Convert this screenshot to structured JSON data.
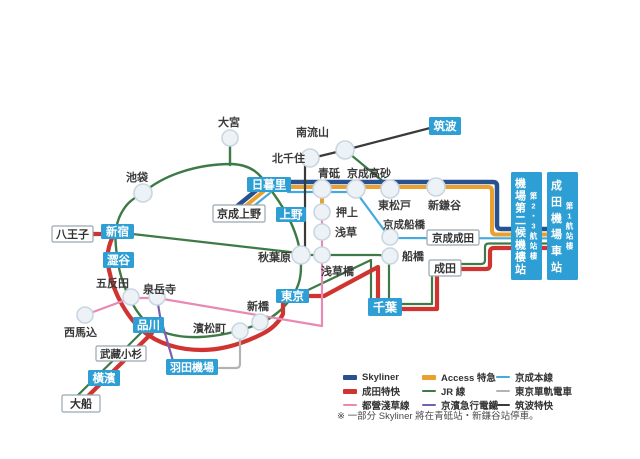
{
  "canvas": {
    "width": 640,
    "height": 459,
    "background": "#ffffff"
  },
  "colors": {
    "skyliner": "#27518f",
    "nex": "#cf3430",
    "asakusa": "#e88ab4",
    "access": "#e9a02c",
    "jr": "#3d7a46",
    "keikyu": "#7a5fae",
    "keisei": "#45aadd",
    "monorail": "#b3b3b3",
    "tsukuba": "#3a3a3a",
    "station_box": "#2e9fd4",
    "circle_fill": "#edf2f7",
    "circle_stroke": "#c9d6e2",
    "label_color": "#3b3b3b"
  },
  "map": {
    "lines": [
      {
        "name": "jr-yamanote-loop",
        "color": "jr",
        "width": 2.4,
        "d": "M143,193 C162,176 195,164 232,164 C252,165 260,174 268,186 C280,202 296,225 300,252 C303,276 299,287 291,298 C283,310 270,320 256,325 C240,331 222,336 200,337 C178,338 158,333 146,322 C132,308 121,283 118,262 C115,244 114,231 119,218 C125,204 132,199 143,193 Z"
      },
      {
        "name": "jr-omiya-spur",
        "color": "jr",
        "width": 2.4,
        "d": "M230,146 L230,165"
      },
      {
        "name": "jr-chuo-line",
        "color": "jr",
        "width": 2.2,
        "d": "M115,232 L299,253"
      },
      {
        "name": "jr-sobu-line",
        "color": "jr",
        "width": 2.2,
        "d": "M301,255 L378,255 Q389,255 389,263 L389,298"
      },
      {
        "name": "jr-sobu-rapid",
        "color": "jr",
        "width": 2.2,
        "d": "M306,291 L371,260 L371,298"
      },
      {
        "name": "jr-musashino-line",
        "color": "jr",
        "width": 2.2,
        "d": "M345,150 L390,187"
      },
      {
        "name": "jr-chiba-narita",
        "color": "jr",
        "width": 2.2,
        "d": "M402,304 L432,304 L432,277"
      },
      {
        "name": "jr-narita-airport",
        "color": "jr",
        "width": 2.2,
        "d": "M460,264 L481,264 Q485,264 485,260 L485,247 Q485,243.5 489,243.5 L575,243.5"
      },
      {
        "name": "jr-shinagawa-ofuna",
        "color": "jr",
        "width": 2.2,
        "d": "M146,328 L74,399"
      },
      {
        "name": "nex-west",
        "color": "nex",
        "width": 4.2,
        "d": "M92,234 L114,234 C108,246 106,256 109,270 C114,295 128,318 143,331 C158,344 180,350 202,350 C226,350 248,341 262,334 C272,329 279,322 283,314 L283,301"
      },
      {
        "name": "nex-tokyo-chiba",
        "color": "nex",
        "width": 4.2,
        "d": "M308,296 L324,296 L378,267 L378,298"
      },
      {
        "name": "nex-chiba-narita",
        "color": "nex",
        "width": 4.2,
        "d": "M402,309 L437,309 L437,277"
      },
      {
        "name": "nex-narita-airport",
        "color": "nex",
        "width": 4.2,
        "d": "M460,269 L486,269 Q490,269 490,265 L490,252 Q490,248 494,248 L575,248"
      },
      {
        "name": "nex-ofuna-branch",
        "color": "nex",
        "width": 4.2,
        "d": "M152,333 L80,404"
      },
      {
        "name": "skyliner-ueno-link",
        "color": "skyliner",
        "width": 4.5,
        "d": "M236,207 L258,189"
      },
      {
        "name": "skyliner-main",
        "color": "skyliner",
        "width": 4.5,
        "d": "M288,182 L493,182 Q497,182 497,186 L497,225 Q497,229 501,229 L575,229"
      },
      {
        "name": "access-ueno-link",
        "color": "access",
        "width": 4,
        "d": "M243,208 L264,191"
      },
      {
        "name": "access-main",
        "color": "access",
        "width": 4,
        "d": "M288,187 L488,187 Q492,187 492,191 L492,230.5 Q492,234.5 496,234.5 L575,234.5"
      },
      {
        "name": "access-oshiage-branch",
        "color": "access",
        "width": 4,
        "d": "M322,212 L322,189"
      },
      {
        "name": "keisei-ueno-link",
        "color": "keisei",
        "width": 2.2,
        "d": "M250,209 L270,193"
      },
      {
        "name": "keisei-main",
        "color": "keisei",
        "width": 2.2,
        "d": "M288,192 L356,192 L387,234 Q389,237 393,238 L575,238.5"
      },
      {
        "name": "toei-asakusa-line",
        "color": "asakusa",
        "width": 2.2,
        "d": "M85,315 L131,298 L157,298 L322,326 L322,212"
      },
      {
        "name": "keikyu-line",
        "color": "keikyu",
        "width": 2.2,
        "d": "M157,298 L160,316 L173,361"
      },
      {
        "name": "tokyo-monorail",
        "color": "monorail",
        "width": 2.2,
        "d": "M240,339 L240,364 Q240,368 236,368 L219,368"
      },
      {
        "name": "tsukuba-express",
        "color": "tsukuba",
        "width": 2.2,
        "d": "M430,128 L345,150 L312,158 Q305,160 305,166 L305,252"
      }
    ],
    "circles": [
      {
        "name": "omiya",
        "x": 230,
        "y": 138,
        "r": 8
      },
      {
        "name": "ikebukuro",
        "x": 143,
        "y": 193,
        "r": 9
      },
      {
        "name": "minami-nagareyama",
        "x": 345,
        "y": 150,
        "r": 9
      },
      {
        "name": "kita-senju",
        "x": 310,
        "y": 158,
        "r": 9
      },
      {
        "name": "aoto",
        "x": 322,
        "y": 189,
        "r": 9
      },
      {
        "name": "keisei-takasago",
        "x": 356,
        "y": 189,
        "r": 9
      },
      {
        "name": "higashi-matsudo",
        "x": 390,
        "y": 189,
        "r": 9
      },
      {
        "name": "shin-kamagaya",
        "x": 436,
        "y": 187,
        "r": 9
      },
      {
        "name": "oshiage",
        "x": 322,
        "y": 212,
        "r": 8
      },
      {
        "name": "asakusa",
        "x": 322,
        "y": 232,
        "r": 8
      },
      {
        "name": "akihabara",
        "x": 301,
        "y": 255,
        "r": 9
      },
      {
        "name": "asakusabashi",
        "x": 322,
        "y": 255,
        "r": 8
      },
      {
        "name": "keisei-funabashi",
        "x": 390,
        "y": 237,
        "r": 8
      },
      {
        "name": "funabashi",
        "x": 390,
        "y": 256,
        "r": 8
      },
      {
        "name": "shimbashi",
        "x": 260,
        "y": 322,
        "r": 8
      },
      {
        "name": "hamamatsucho",
        "x": 240,
        "y": 331,
        "r": 8
      },
      {
        "name": "gotanda",
        "x": 131,
        "y": 297,
        "r": 8
      },
      {
        "name": "sengakuji",
        "x": 157,
        "y": 297,
        "r": 8
      },
      {
        "name": "nishi-magome",
        "x": 85,
        "y": 315,
        "r": 8
      }
    ],
    "station_boxes": [
      {
        "name": "nippori",
        "label": "日暮里",
        "style": "blue",
        "x": 247,
        "y": 177,
        "w": 44,
        "h": 15,
        "fs": 11.5
      },
      {
        "name": "ueno",
        "label": "上野",
        "style": "blue",
        "x": 276,
        "y": 207,
        "w": 30,
        "h": 15,
        "fs": 11.5
      },
      {
        "name": "shinjuku",
        "label": "新宿",
        "style": "blue",
        "x": 101,
        "y": 224,
        "w": 33,
        "h": 15,
        "fs": 11.5
      },
      {
        "name": "shibuya",
        "label": "澀谷",
        "style": "blue",
        "x": 103,
        "y": 252,
        "w": 31,
        "h": 16,
        "fs": 11.5
      },
      {
        "name": "shinagawa",
        "label": "品川",
        "style": "blue",
        "x": 133,
        "y": 317,
        "w": 31,
        "h": 16,
        "fs": 11.5
      },
      {
        "name": "tokyo",
        "label": "東京",
        "style": "blue",
        "x": 276,
        "y": 289,
        "w": 33,
        "h": 14,
        "fs": 11.5
      },
      {
        "name": "chiba",
        "label": "千葉",
        "style": "blue",
        "x": 368,
        "y": 298,
        "w": 34,
        "h": 18,
        "fs": 12
      },
      {
        "name": "tsukuba",
        "label": "筑波",
        "style": "blue",
        "x": 429,
        "y": 117,
        "w": 32,
        "h": 18,
        "fs": 11.5
      },
      {
        "name": "haneda-airport",
        "label": "羽田機場",
        "style": "blue",
        "x": 166,
        "y": 359,
        "w": 52,
        "h": 16,
        "fs": 11
      },
      {
        "name": "yokohama",
        "label": "橫濱",
        "style": "blue",
        "x": 88,
        "y": 370,
        "w": 32,
        "h": 16,
        "fs": 11.5
      },
      {
        "name": "hachioji",
        "label": "八王子",
        "style": "white",
        "x": 52,
        "y": 226,
        "w": 41,
        "h": 16,
        "fs": 11
      },
      {
        "name": "keisei-ueno",
        "label": "京成上野",
        "style": "white",
        "x": 213,
        "y": 205,
        "w": 52,
        "h": 17,
        "fs": 11
      },
      {
        "name": "musashi-kosugi",
        "label": "武藏小杉",
        "style": "white",
        "x": 96,
        "y": 346,
        "w": 50,
        "h": 15,
        "fs": 10.5
      },
      {
        "name": "ofuna",
        "label": "大船",
        "style": "white",
        "x": 62,
        "y": 395,
        "w": 38,
        "h": 17,
        "fs": 11
      },
      {
        "name": "keisei-narita",
        "label": "京成成田",
        "style": "white",
        "x": 427,
        "y": 230,
        "w": 52,
        "h": 15,
        "fs": 10.5
      },
      {
        "name": "narita",
        "label": "成田",
        "style": "white",
        "x": 429,
        "y": 260,
        "w": 32,
        "h": 16,
        "fs": 11
      }
    ],
    "terminal_boxes": [
      {
        "name": "airport-terminal2-station",
        "main": "機場第二候機樓站",
        "sub": "第2・3航站樓",
        "x": 511,
        "y": 172,
        "w": 31,
        "h": 108
      },
      {
        "name": "narita-airport-station",
        "main": "成田機場車站",
        "sub": "第1航站樓",
        "x": 547,
        "y": 172,
        "w": 31,
        "h": 108
      }
    ],
    "labels": [
      {
        "name": "omiya-label",
        "text": "大宮",
        "x": 218,
        "y": 126,
        "fs": 11
      },
      {
        "name": "ikebukuro-label",
        "text": "池袋",
        "x": 126,
        "y": 181,
        "fs": 11
      },
      {
        "name": "minami-nagareyama-label",
        "text": "南流山",
        "x": 296,
        "y": 136,
        "fs": 11
      },
      {
        "name": "kita-senju-label",
        "text": "北千住",
        "x": 272,
        "y": 162,
        "fs": 11
      },
      {
        "name": "aoto-label",
        "text": "青砥",
        "x": 318,
        "y": 177,
        "fs": 11
      },
      {
        "name": "keisei-takasago-label",
        "text": "京成高砂",
        "x": 347,
        "y": 177,
        "fs": 11
      },
      {
        "name": "higashi-matsudo-label",
        "text": "東松戸",
        "x": 378,
        "y": 209,
        "fs": 11
      },
      {
        "name": "shin-kamagaya-label",
        "text": "新鎌谷",
        "x": 428,
        "y": 209,
        "fs": 11
      },
      {
        "name": "oshiage-label",
        "text": "押上",
        "x": 336,
        "y": 216,
        "fs": 11
      },
      {
        "name": "asakusa-label",
        "text": "浅草",
        "x": 335,
        "y": 236,
        "fs": 11
      },
      {
        "name": "akihabara-label",
        "text": "秋葉原",
        "x": 258,
        "y": 261,
        "fs": 11
      },
      {
        "name": "asakusabashi-label",
        "text": "浅草橋",
        "x": 321,
        "y": 275,
        "fs": 11
      },
      {
        "name": "keisei-funabashi-label",
        "text": "京成船橋",
        "x": 383,
        "y": 228,
        "fs": 10.5
      },
      {
        "name": "funabashi-label",
        "text": "船橋",
        "x": 402,
        "y": 260,
        "fs": 11
      },
      {
        "name": "gotanda-label",
        "text": "五反田",
        "x": 96,
        "y": 287,
        "fs": 11
      },
      {
        "name": "sengakuji-label",
        "text": "泉岳寺",
        "x": 143,
        "y": 293,
        "fs": 11
      },
      {
        "name": "nishi-magome-label",
        "text": "西馬込",
        "x": 64,
        "y": 336,
        "fs": 11
      },
      {
        "name": "shimbashi-label",
        "text": "新橋",
        "x": 247,
        "y": 310,
        "fs": 11
      },
      {
        "name": "hamamatsucho-label",
        "text": "濱松町",
        "x": 193,
        "y": 332,
        "fs": 11
      }
    ]
  },
  "legend": {
    "items": [
      {
        "label": "Skyliner",
        "color": "skyliner",
        "thick": true
      },
      {
        "label": "成田特快",
        "color": "nex",
        "thick": true
      },
      {
        "label": "都營淺草線",
        "color": "asakusa",
        "thick": false
      },
      {
        "label": "Access 特急",
        "color": "access",
        "thick": true
      },
      {
        "label": "JR 線",
        "color": "jr",
        "thick": false
      },
      {
        "label": "京濱急行電鐵",
        "color": "keikyu",
        "thick": false
      },
      {
        "label": "京成本線",
        "color": "keisei",
        "thick": false
      },
      {
        "label": "東京單軌電車",
        "color": "monorail",
        "thick": false
      },
      {
        "label": "筑波特快",
        "color": "tsukuba",
        "thick": false
      }
    ],
    "note": "※ 一部分 Skyliner 將在青砥站・新鎌谷站停車。"
  }
}
